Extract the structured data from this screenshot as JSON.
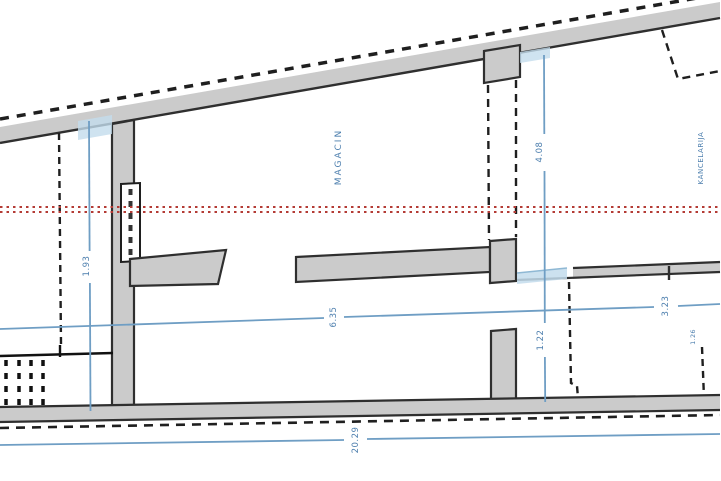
{
  "drawing": {
    "kind": "architectural floor plan section",
    "labels": {
      "room_center": "MAGACIN",
      "room_right": "KANCELARIJA"
    },
    "dimensions": {
      "left_vertical": "1.93",
      "right_vertical_upper": "4.08",
      "right_vertical_lower": "1.22",
      "center_horizontal": "6.35",
      "right_horizontal": "3.23",
      "bottom_overall": "20.29",
      "right_small": "1.26"
    },
    "colors": {
      "background": "#ffffff",
      "wall_fill": "#cbcbcb",
      "wall_edge": "#2f2f2f",
      "dashed_line": "#1f1f1f",
      "dimension_blue": "#6f9ec4",
      "dimension_text_blue": "#4d7fae",
      "reference_red": "#b43b35",
      "window_highlight_blue": "#c3dcec"
    }
  }
}
